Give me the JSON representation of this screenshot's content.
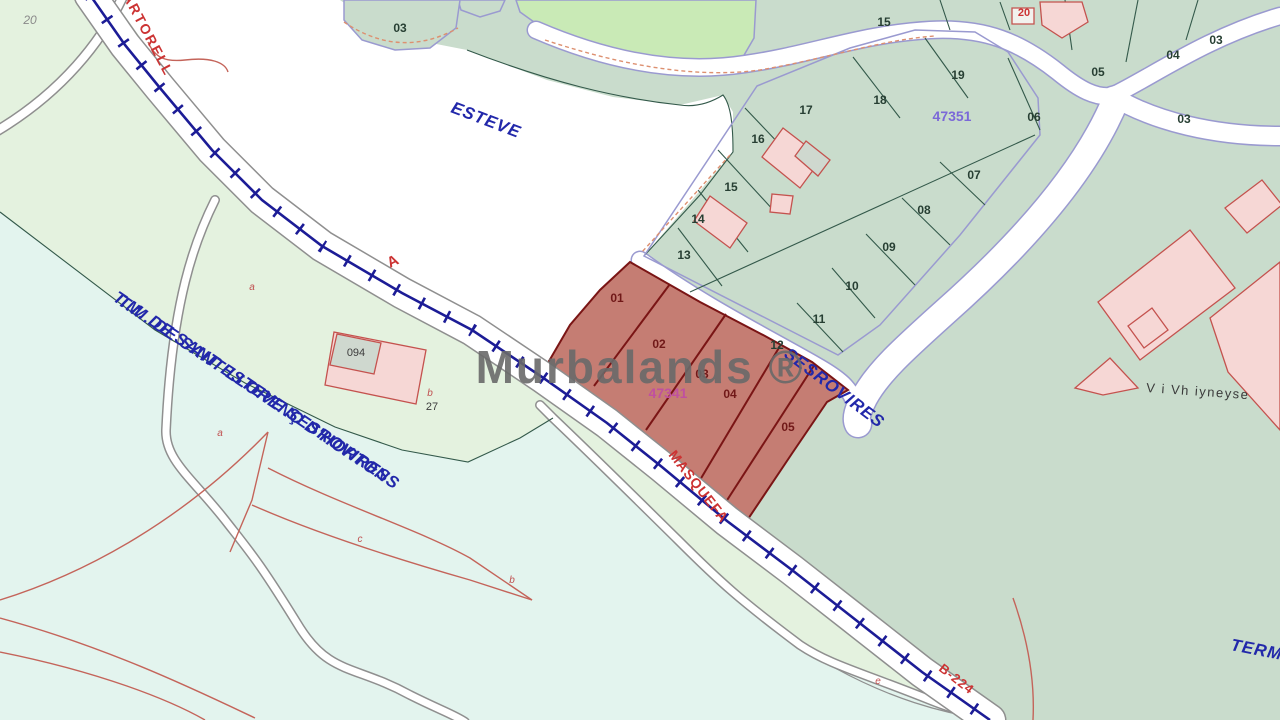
{
  "watermark": "Murbalands ®",
  "place_labels": {
    "martorell": "MARTORELL",
    "esteve": "ESTEVE",
    "tm_line1": "T.M. DE SANT ESTEVE SESROVIRES",
    "tm_line2": "T.M. DE SANT LLORENÇ D'HORTONS",
    "sesrovires": "SESROVIRES",
    "masquefa": "MASQUEFA",
    "b224": "B-224",
    "terme": "TERME",
    "village": "V i Vh iyneyse",
    "rail_letter_a": "A"
  },
  "cadastral_refs": {
    "green_block": "47351",
    "red_block": "47341"
  },
  "parcel_labels": {
    "corner": "20",
    "pond": "03",
    "top_band": [
      "15",
      "20",
      "19",
      "18",
      "17",
      "05",
      "04",
      "03"
    ],
    "center_block": [
      "16",
      "15",
      "14",
      "13",
      "06",
      "07",
      "08",
      "09",
      "10",
      "11",
      "12"
    ],
    "east": "03",
    "red": [
      "01",
      "02",
      "03",
      "04",
      "05"
    ]
  },
  "small_labels": {
    "building": "094",
    "plot27": "27",
    "letter_b": "b",
    "letter_a1": "a",
    "letter_a2": "a",
    "letter_c": "c",
    "letter_b2": "b",
    "letter_e": "e"
  },
  "colors": {
    "railway": "#1c1c96",
    "red-parcel": "#c57d73",
    "sage": "#c9dccc",
    "cyan": "#e3f4ee",
    "light-green": "#c9eab6",
    "road-edge": "#9a9ad0",
    "blue-text": "#2228aa",
    "red-text": "#cc3333",
    "watermark": "#6a6a6a"
  }
}
